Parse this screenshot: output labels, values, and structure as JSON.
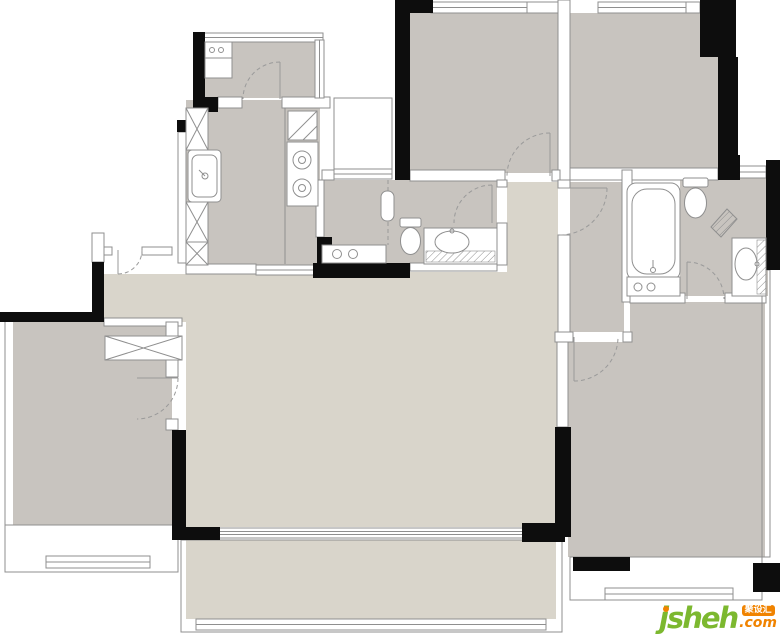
{
  "watermark": {
    "brand": "jsheh",
    "badge": "聚设汇",
    "tld": ".com"
  },
  "colors": {
    "wall": "#0d0d0d",
    "room-gray": "#c8c4bf",
    "living-beige": "#d9d5cb",
    "outline": "#8f8f8f",
    "door-line": "#9a9a9a",
    "brand-green": "#7cb82f",
    "brand-orange": "#f08300",
    "paper": "#ffffff"
  }
}
